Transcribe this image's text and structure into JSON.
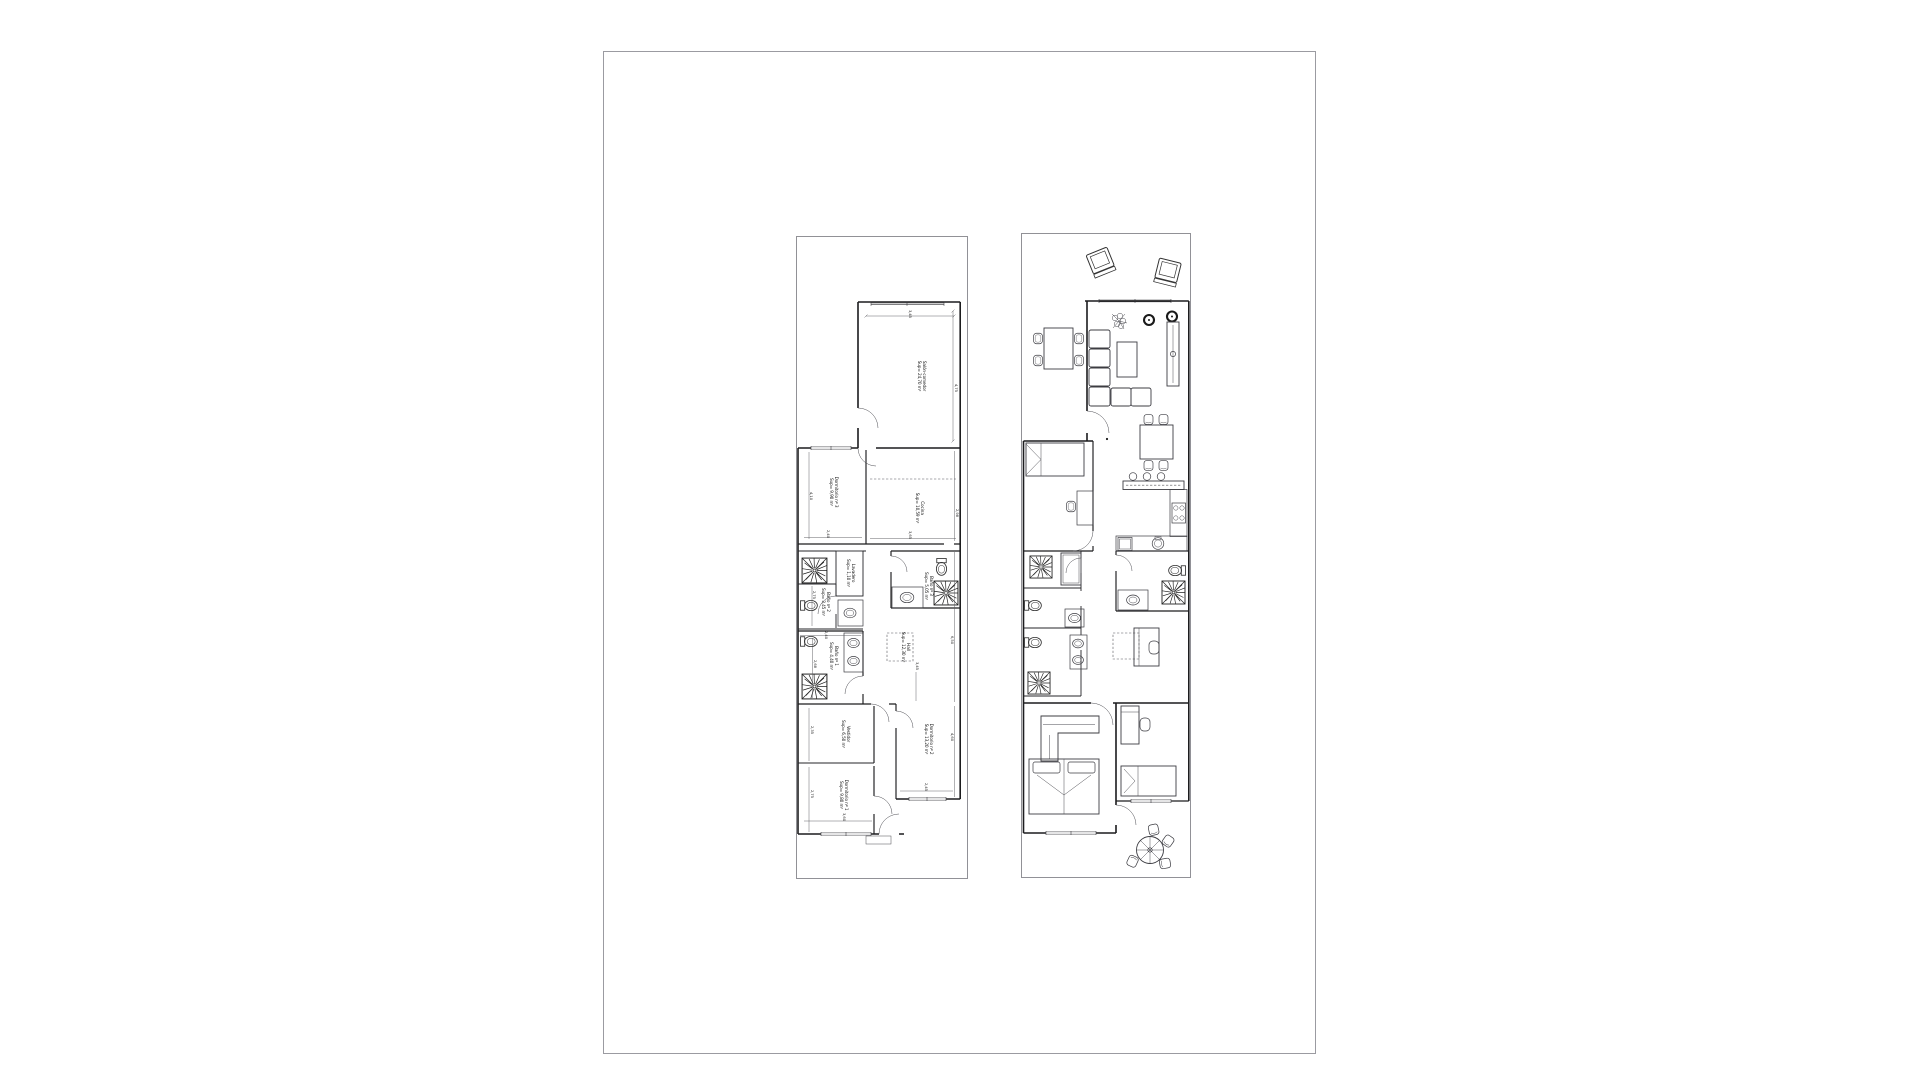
{
  "sheet": {
    "background": "#ffffff",
    "border_color": "#9b9ba1",
    "line_color": "#1c1c1e"
  },
  "plans": {
    "left": {
      "name": "dimensioned plan",
      "rooms": [
        {
          "label": "Salón-comedor",
          "area": "Sup= 24,70 m²",
          "x": 126,
          "y": 140
        },
        {
          "label": "Dormitorio nº 3",
          "area": "Sup= 9,90 m²",
          "x": 38,
          "y": 256
        },
        {
          "label": "Cocina",
          "area": "Sup= 10,59 m²",
          "x": 124,
          "y": 272
        },
        {
          "label": "Lavadero",
          "area": "Sup= 1,10 m²",
          "x": 55,
          "y": 337
        },
        {
          "label": "Baño nº 2",
          "area": "Sup= 3,45 m²",
          "x": 30,
          "y": 366
        },
        {
          "label": "Baño nº 3",
          "area": "Sup= 5,05 m²",
          "x": 133,
          "y": 350
        },
        {
          "label": "Baño nº 1",
          "area": "Sup= 4,40 m²",
          "x": 38,
          "y": 420
        },
        {
          "label": "Hall",
          "area": "Sup= 12,30 m²",
          "x": 110,
          "y": 411
        },
        {
          "label": "Vestidor",
          "area": "Sup= 6,50 m²",
          "x": 50,
          "y": 498
        },
        {
          "label": "Dormitorio nº 2",
          "area": "Sup= 13,20 m²",
          "x": 133,
          "y": 503
        },
        {
          "label": "Dormitorio nº 1",
          "area": "Sup= 9,80 m²",
          "x": 48,
          "y": 559
        }
      ],
      "dimensions": [
        {
          "text": "3,45",
          "x": 114,
          "y": 78
        },
        {
          "text": "4,75",
          "x": 160,
          "y": 152
        },
        {
          "text": "4,10",
          "x": 15,
          "y": 260
        },
        {
          "text": "2,40",
          "x": 32,
          "y": 298
        },
        {
          "text": "3,65",
          "x": 114,
          "y": 299
        },
        {
          "text": "2,98",
          "x": 161,
          "y": 277
        },
        {
          "text": "2,75",
          "x": 18,
          "y": 359
        },
        {
          "text": "2,40",
          "x": 30,
          "y": 399
        },
        {
          "text": "2,68",
          "x": 19,
          "y": 428
        },
        {
          "text": "3,45",
          "x": 121,
          "y": 430
        },
        {
          "text": "6,50",
          "x": 156,
          "y": 404
        },
        {
          "text": "2,35",
          "x": 16,
          "y": 494
        },
        {
          "text": "4,60",
          "x": 156,
          "y": 501
        },
        {
          "text": "2,45",
          "x": 130,
          "y": 551
        },
        {
          "text": "2,75",
          "x": 16,
          "y": 558
        },
        {
          "text": "3,60",
          "x": 48,
          "y": 581
        }
      ]
    },
    "right": {
      "name": "furnished plan",
      "furniture": [
        "armchair",
        "plant",
        "side-table",
        "corner-sofa",
        "coffee-table",
        "tv-sideboard",
        "dining-table",
        "bed",
        "desk",
        "bar-counter",
        "bar-stool",
        "cooktop",
        "sink",
        "dishwasher",
        "washing-machine",
        "extractor-fan",
        "toilet",
        "washbasin",
        "wardrobe",
        "double-bed",
        "single-bed",
        "garden-table",
        "garden-chair"
      ]
    }
  }
}
